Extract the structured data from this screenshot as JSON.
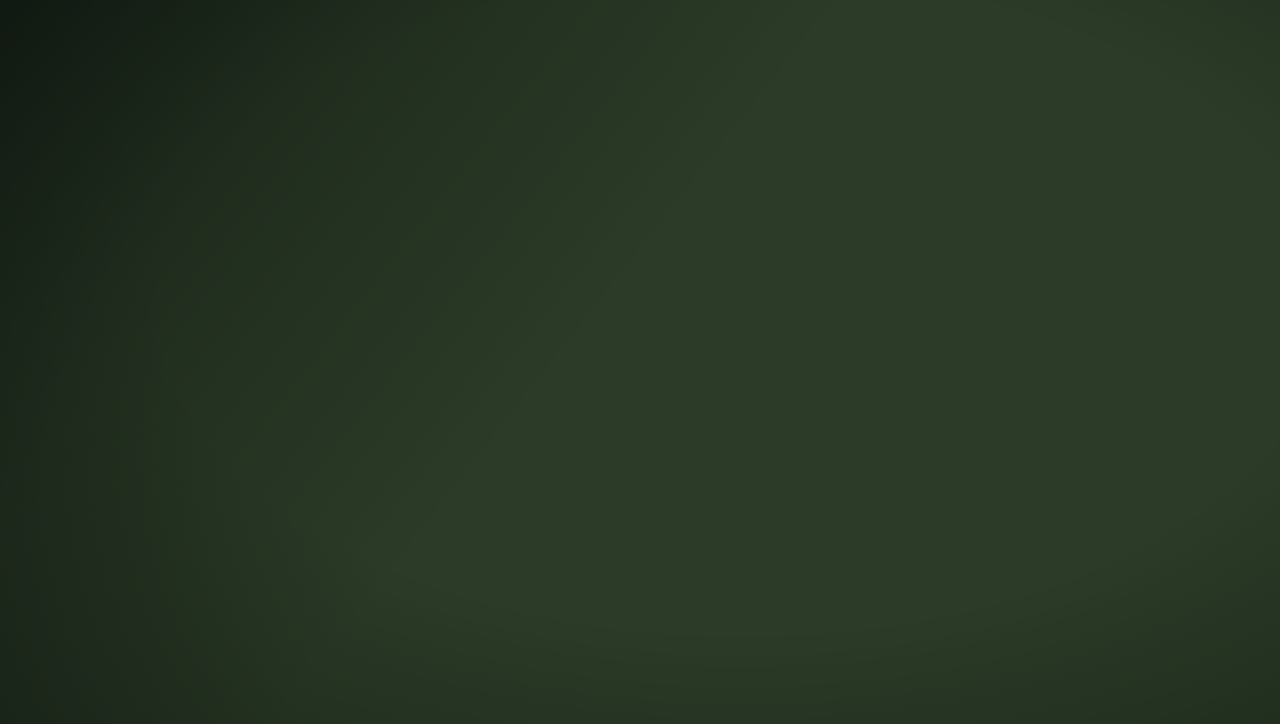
{
  "title": {
    "text": "两轴双环"
  },
  "labels": {
    "axis_corridor": "繁花长廊（约200米）",
    "inner_ring_walkway": "约1.1km内环景观步道",
    "outer_ring_walkway": "外环景观步道",
    "waterfront_park": "水岸公园",
    "eco_wetland_corridor": "生态湿地走廊",
    "brand": "SHANGHAI JIANFA",
    "disclaimer": "建发海宸建筑及景观效果示意图（过程稿），仅供参考；外立面造型、分割、颜色配置或有调整；不同楼栋单元及效果存在差异，本公司保留对本图优化的权利。制作时间：2025年7月，有效期截至：2025年8月。"
  },
  "colors": {
    "ring_road": "#9e4f30",
    "gold_dash": "#e9a243",
    "river": "#8ec4cc",
    "gold_text": "#d9b97f",
    "title_gold": "#e8d3a2",
    "eco_text": "#f3f2ed"
  }
}
